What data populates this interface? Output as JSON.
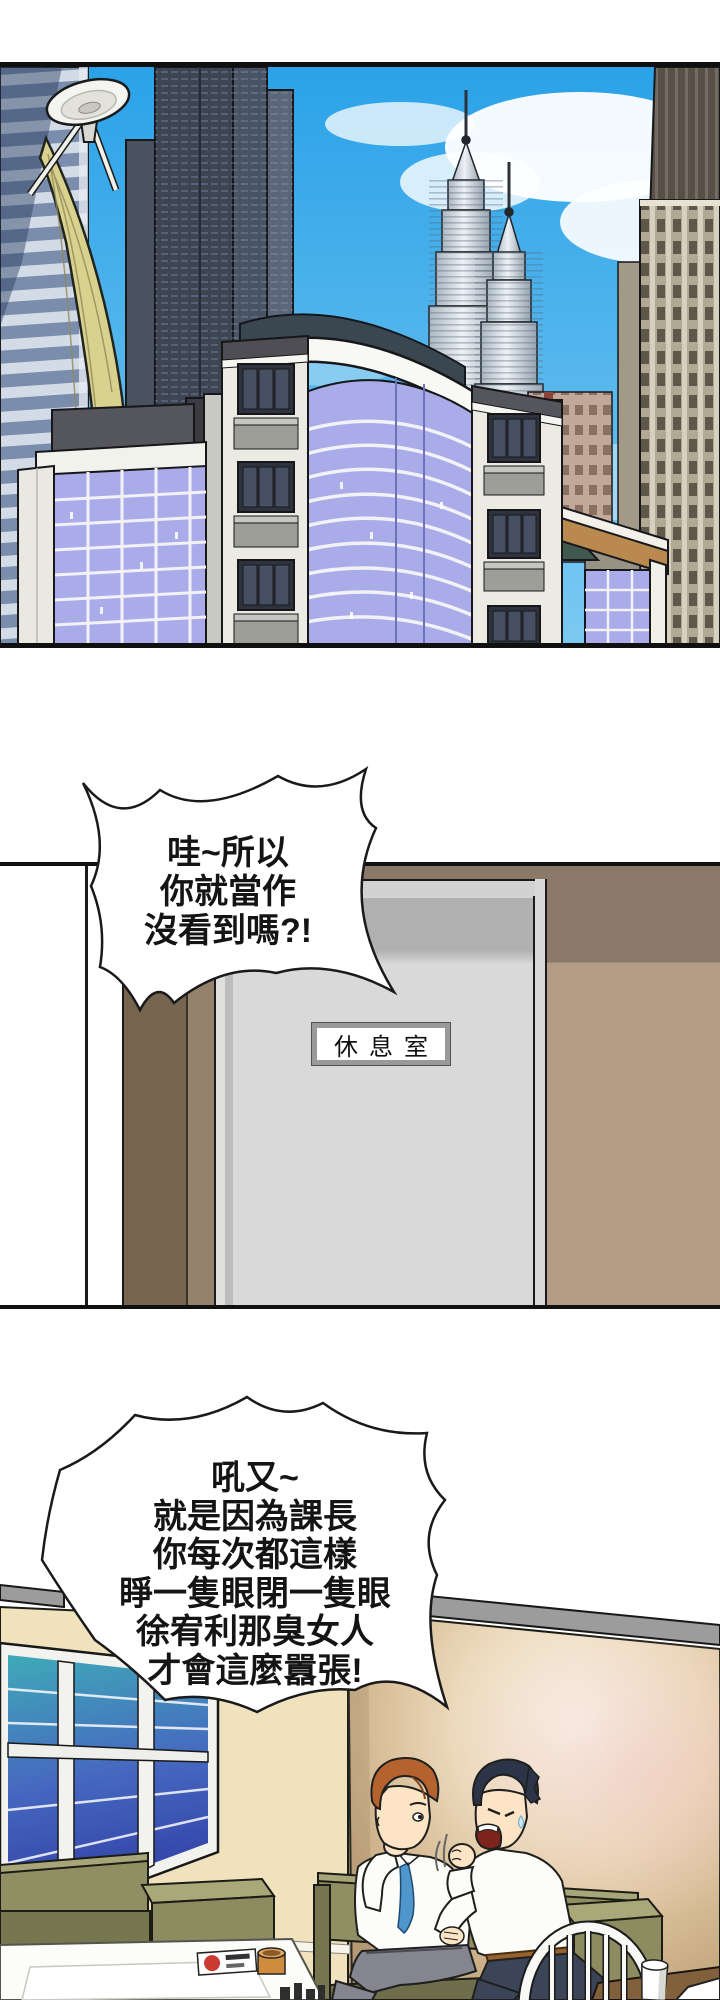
{
  "meta": {
    "width_px": 720,
    "height_px": 2000,
    "kind": "comic page"
  },
  "panels": {
    "city": {
      "name": "city-skyline-panel"
    },
    "hallway": {
      "door_sign": "休息室"
    },
    "lounge": {
      "name": "break-room-panel"
    }
  },
  "speech_bubbles": [
    {
      "id": "bubble-1",
      "lines": [
        "哇~所以",
        "你就當作",
        "沒看到嗎?!"
      ]
    },
    {
      "id": "bubble-2",
      "lines": [
        "吼又~",
        "就是因為課長",
        "你每次都這樣",
        "睜一隻眼閉一隻眼",
        "徐宥利那臭女人",
        "才會這麼囂張!"
      ]
    }
  ],
  "colors": {
    "sky": "#2ea6ea",
    "lavender_glass": "#a9ace9",
    "sail_yellow": "#d9d28e",
    "dark_tower": "#3e4552",
    "twin_tower_silver": "#c8d2da",
    "hall_wall_brown": "#8a7968",
    "hall_wall_tan": "#b39b86",
    "door_grey": "#d9d9d9",
    "room_wall_cream": "#efe2bc",
    "room_wall_tan": "#c9ae87",
    "window_glass_top": "#3fa8b8",
    "window_glass_bottom": "#2e3ca2",
    "couch_olive": "#8c8c60",
    "tie_blue": "#4e96cc",
    "hair_orange": "#b4632e",
    "hair_black": "#2c3447",
    "pants_grey": "#85858f",
    "pants_navy": "#3c4458",
    "belt_brown": "#96622c",
    "mug_orange": "#cf8c3e",
    "sign_border_grey": "#9a9a9a"
  }
}
